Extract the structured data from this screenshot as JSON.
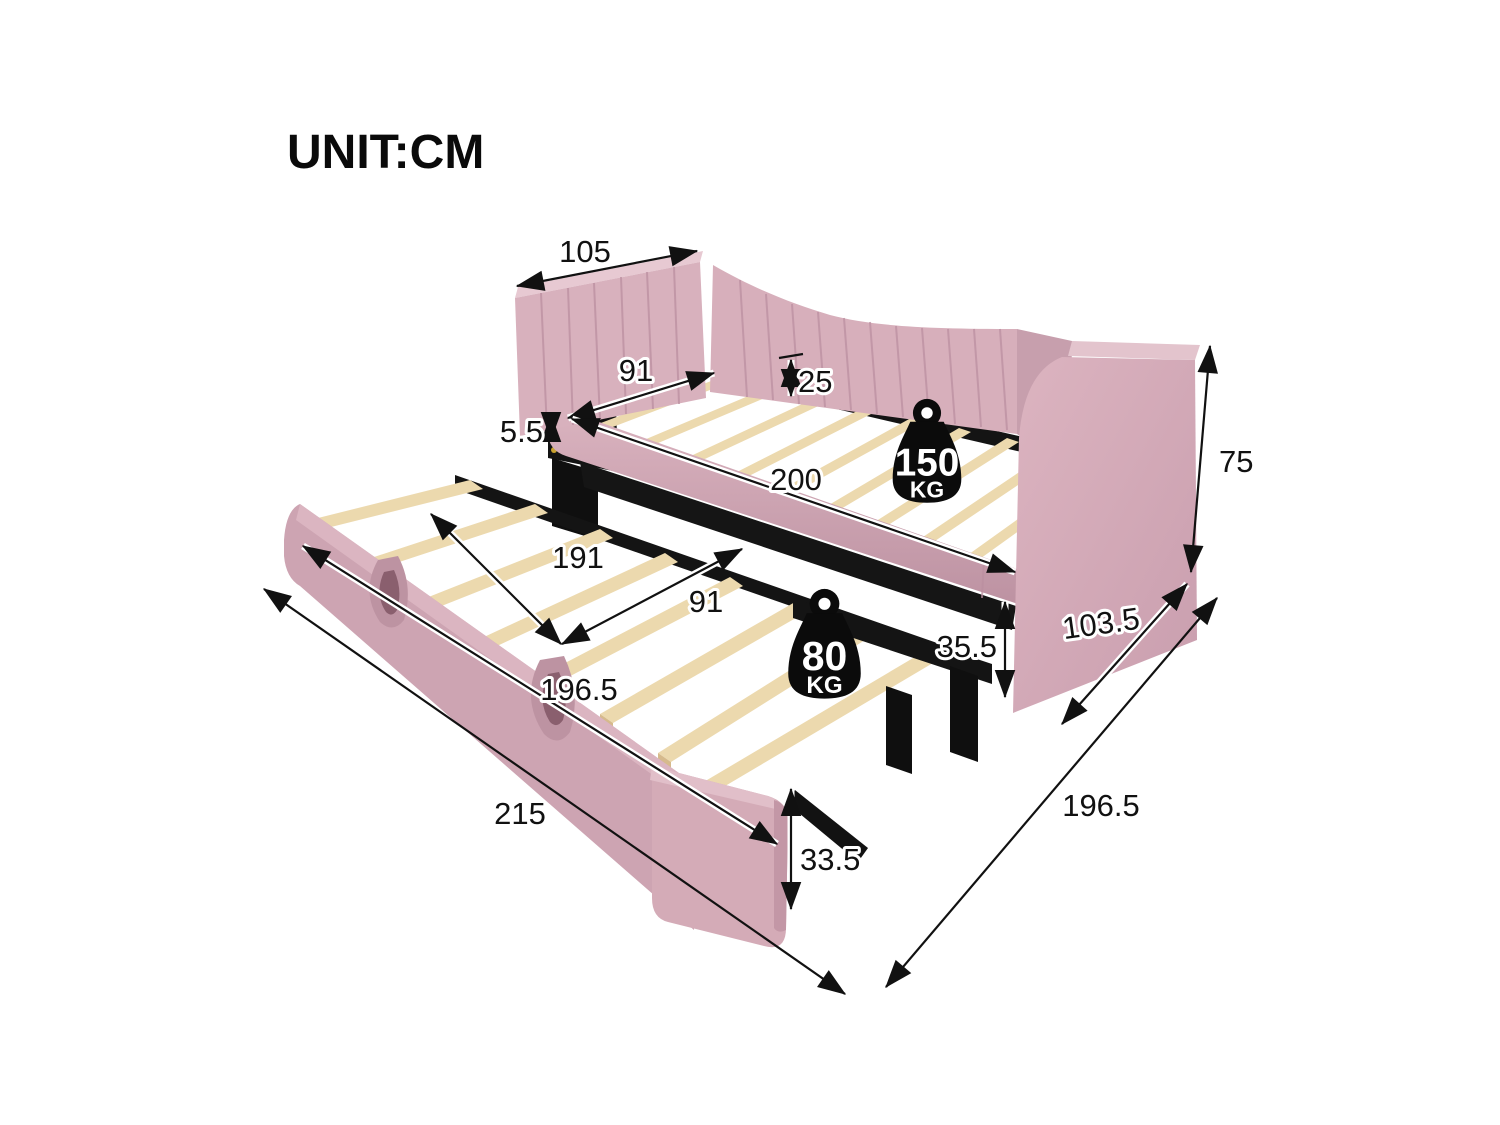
{
  "header": {
    "unit_label": "UNIT:CM"
  },
  "overall": {
    "length": "215",
    "depth": "196.5"
  },
  "daybed": {
    "headboard_width": "105",
    "clear_width": "91",
    "slat_height": "25",
    "rail_thickness": "5.5",
    "length": "200",
    "back_height": "75",
    "arm_depth": "103.5",
    "capacity": {
      "value": "150",
      "unit": "KG"
    }
  },
  "trundle": {
    "inner_length": "191",
    "width": "91",
    "frame_height": "35.5",
    "length": "196.5",
    "board_height": "33.5",
    "capacity": {
      "value": "80",
      "unit": "KG"
    }
  },
  "colors": {
    "fabric": "#d5aab7",
    "fabric_dark": "#c79fad",
    "wood": "#ecd9ae",
    "frame_black": "#141414",
    "dimension_ink": "#111111"
  }
}
